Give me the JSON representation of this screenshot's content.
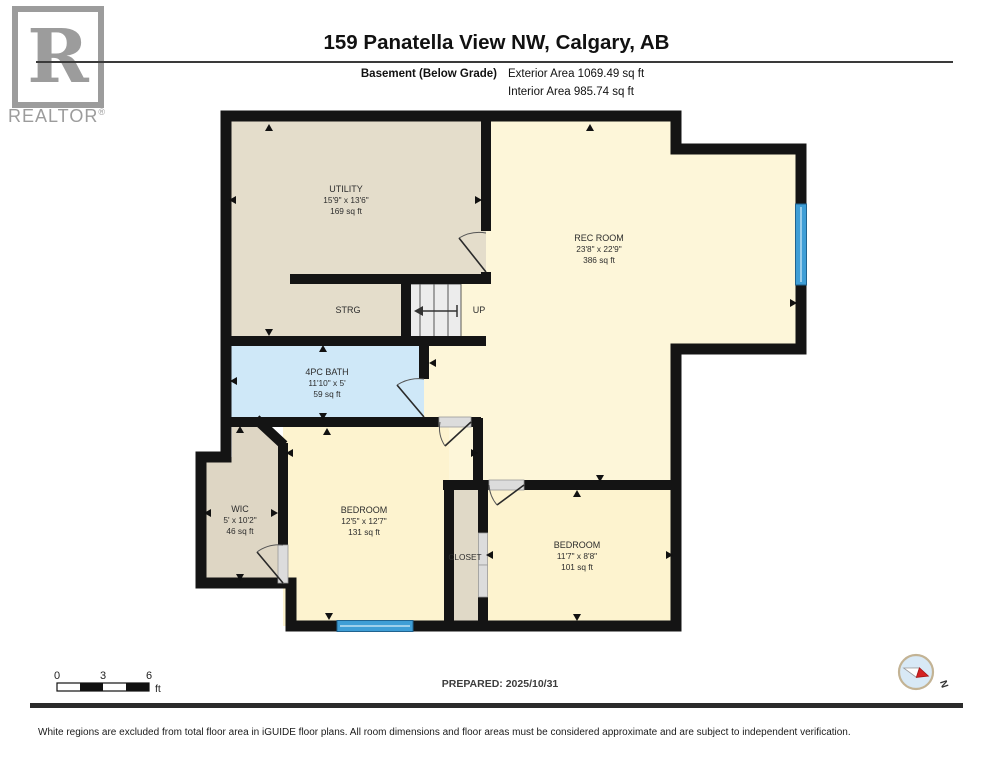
{
  "header": {
    "logo_letter": "R",
    "logo_text": "REALTOR",
    "logo_reg": "®",
    "title": "159 Panatella View NW, Calgary, AB",
    "floor_label": "Basement (Below Grade)",
    "exterior_area": "Exterior Area 1069.49 sq ft",
    "interior_area": "Interior Area 985.74 sq ft"
  },
  "rooms": {
    "utility": {
      "name": "UTILITY",
      "dims": "15'9\" x 13'6\"",
      "area": "169 sq ft"
    },
    "rec_room": {
      "name": "REC ROOM",
      "dims": "23'8\" x 22'9\"",
      "area": "386 sq ft"
    },
    "bath": {
      "name": "4PC BATH",
      "dims": "11'10\" x 5'",
      "area": "59 sq ft"
    },
    "wic": {
      "name": "WIC",
      "dims": "5' x 10'2\"",
      "area": "46 sq ft"
    },
    "bedroom1": {
      "name": "BEDROOM",
      "dims": "12'5\" x 12'7\"",
      "area": "131 sq ft"
    },
    "bedroom2": {
      "name": "BEDROOM",
      "dims": "11'7\" x 8'8\"",
      "area": "101 sq ft"
    },
    "storage_label": "STRG",
    "stairs_label": "UP",
    "closet_label": "CLOSET"
  },
  "footer": {
    "scale_ticks": [
      "0",
      "3",
      "6"
    ],
    "scale_unit": "ft",
    "prepared": "PREPARED: 2025/10/31",
    "compass_north": "N",
    "disclaimer": "White regions are excluded from total floor area in iGUIDE floor plans. All room dimensions and floor areas must be considered approximate and are subject to independent verification."
  },
  "colors": {
    "room_tan": "#e4ddcb",
    "room_yellow": "#fdf6d9",
    "room_blue": "#cfe8f8",
    "window_blue": "#3f9ed6",
    "wall": "#141414",
    "stairs_gray": "#ececec"
  }
}
